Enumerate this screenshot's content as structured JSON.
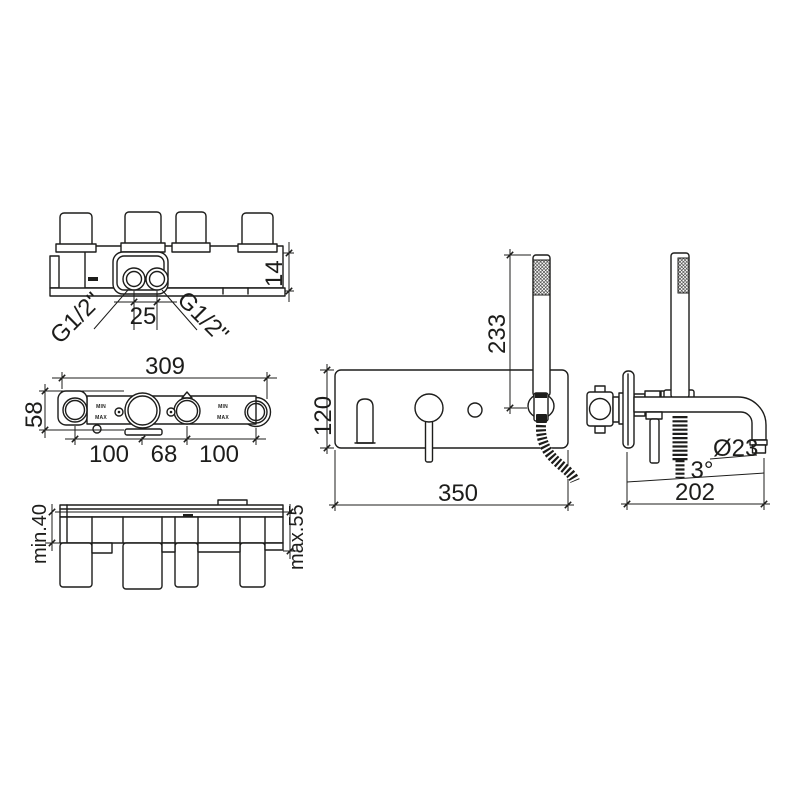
{
  "drawing": {
    "background": "#ffffff",
    "line_color": "#1d1d1b",
    "views": {
      "top_view": {
        "labels": {
          "thread_left": "G1/2\"",
          "thread_right": "G1/2\"",
          "inlet_distance": "25",
          "plate_thickness": "14"
        }
      },
      "rough_front_view": {
        "labels": {
          "overall_width": "309",
          "body_height": "58",
          "spacing_left": "100",
          "spacing_center": "68",
          "spacing_right": "100",
          "min_marker": "MIN",
          "max_marker": "MAX"
        }
      },
      "depth_view": {
        "labels": {
          "min_depth": "min.40",
          "max_depth": "max.55"
        }
      },
      "trim_front_view": {
        "labels": {
          "handshower_height": "233",
          "plate_height": "120",
          "plate_width": "350"
        }
      },
      "trim_side_view": {
        "labels": {
          "spout_diameter": "Ø23",
          "spout_angle": "3°",
          "spout_reach": "202"
        }
      }
    }
  }
}
